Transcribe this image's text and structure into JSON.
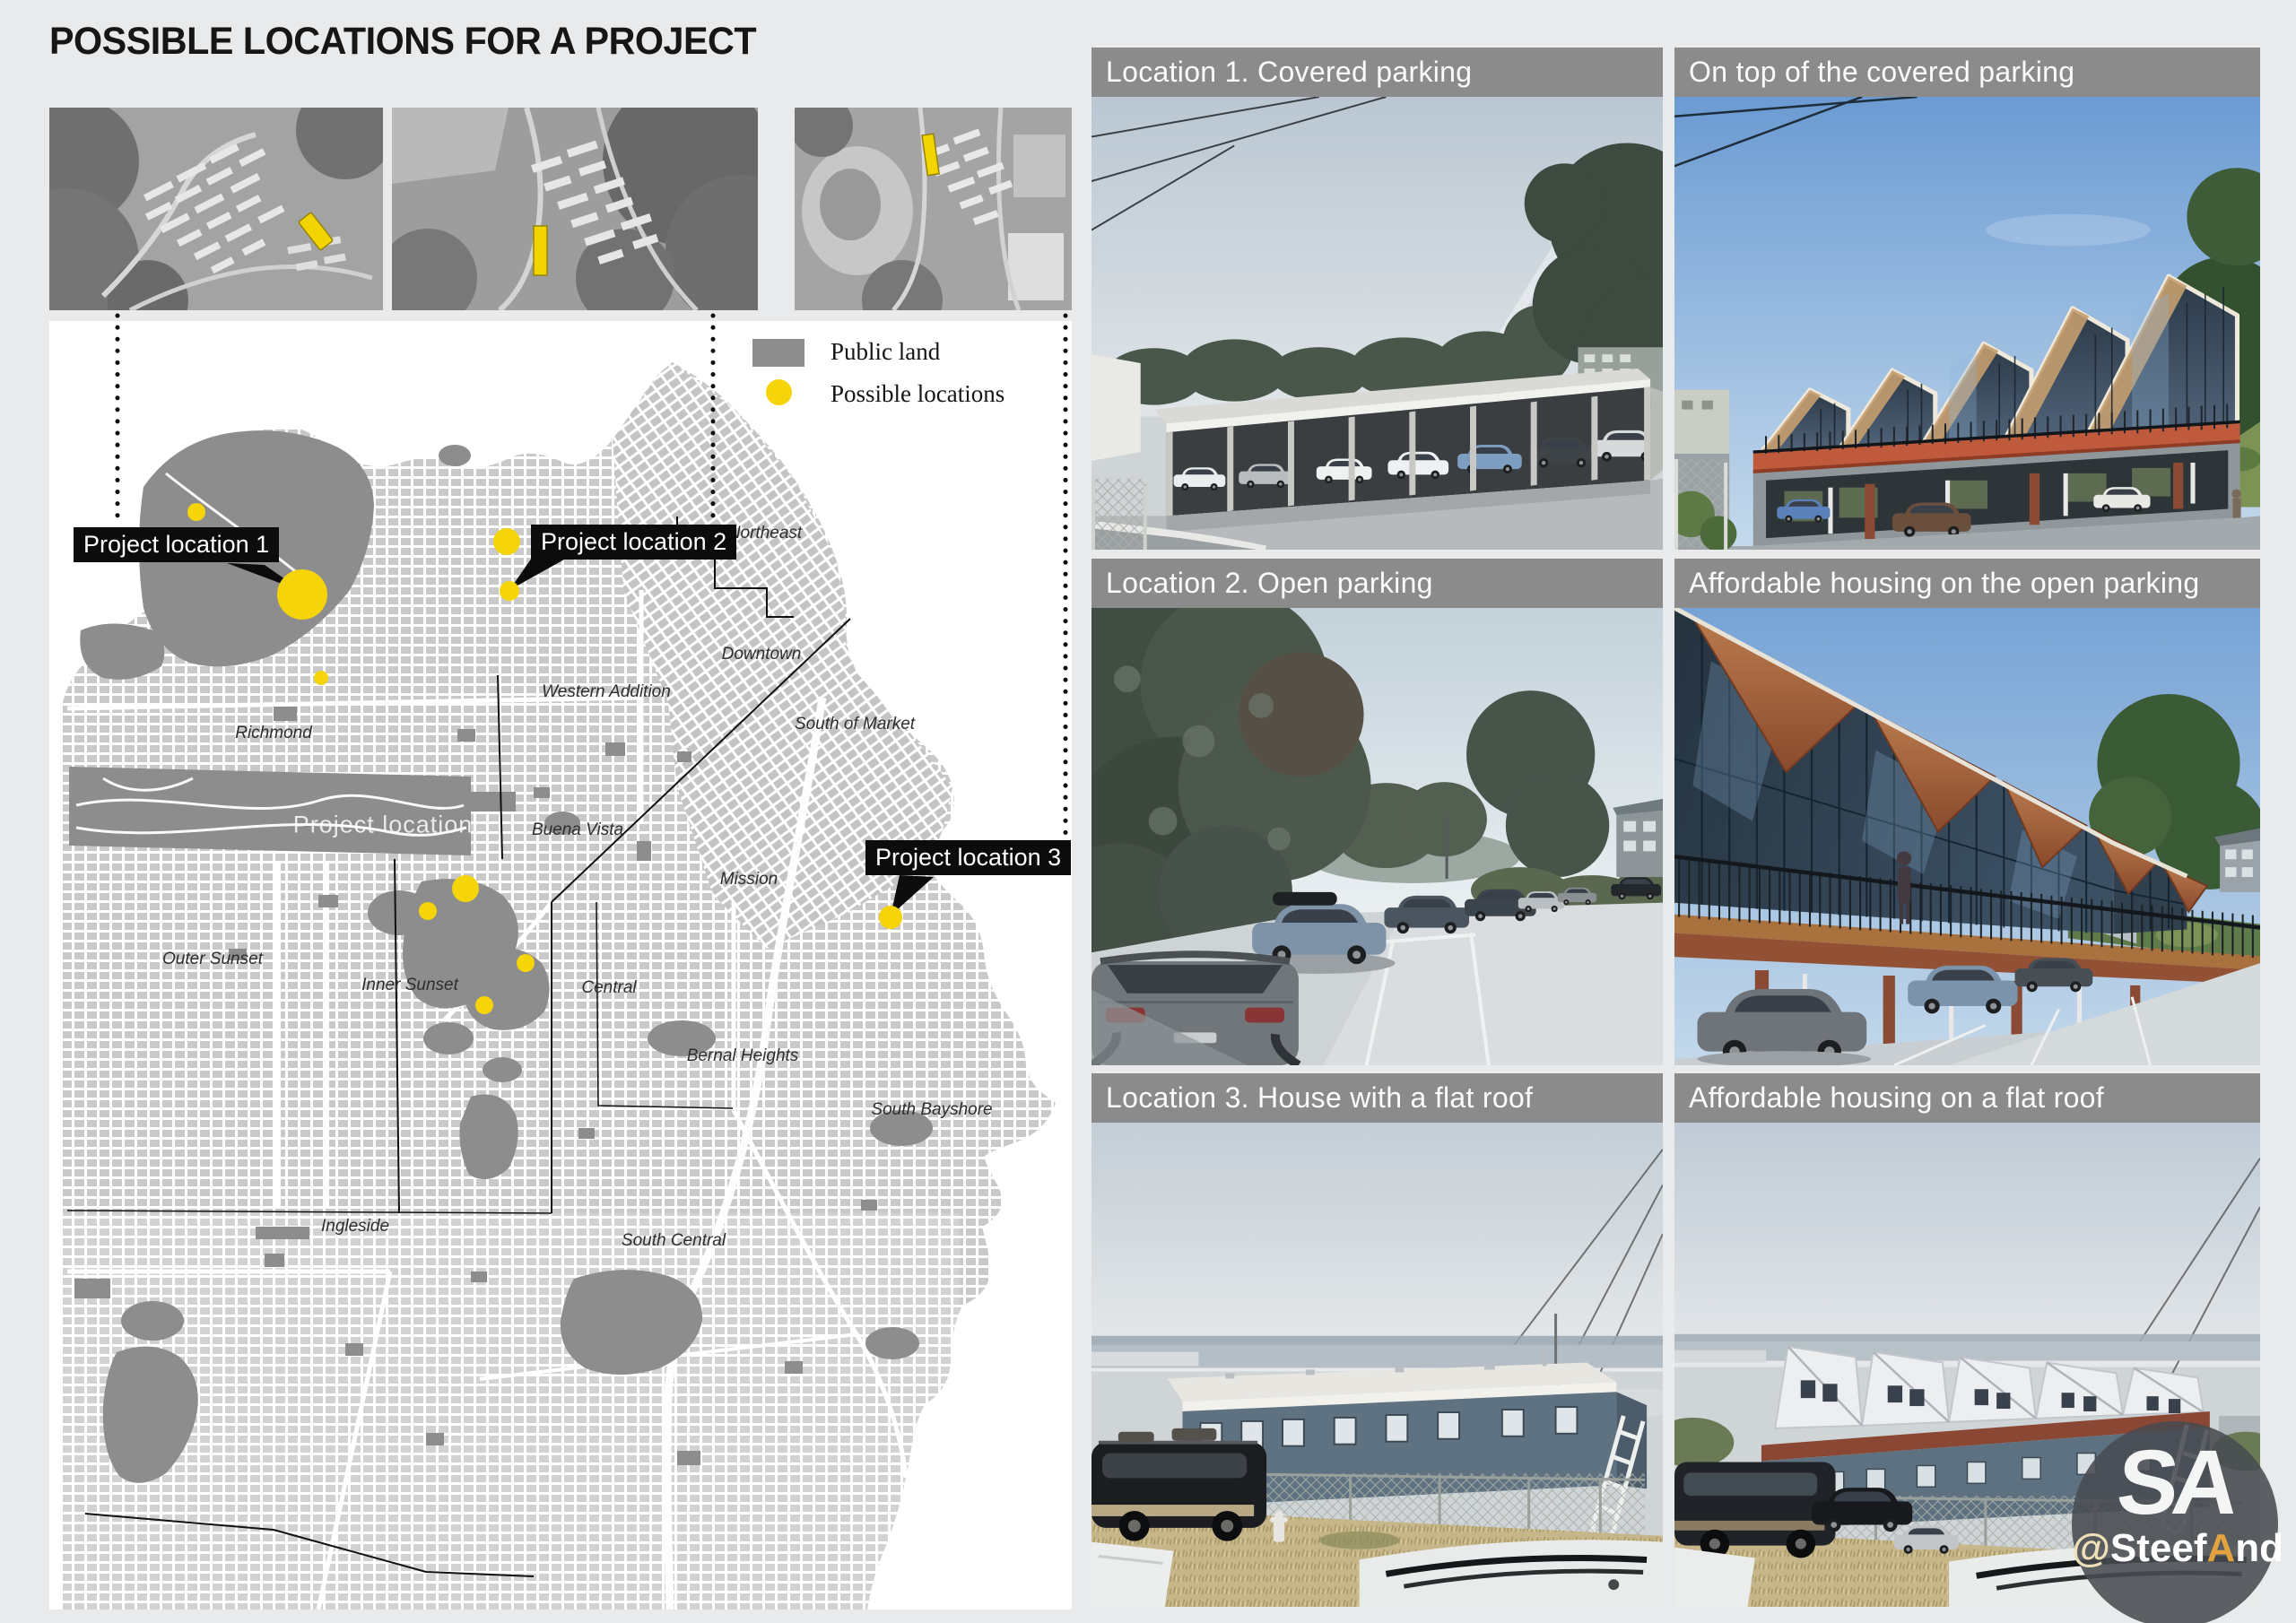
{
  "page": {
    "title": "POSSIBLE LOCATIONS FOR A PROJECT"
  },
  "map": {
    "legend": {
      "public_land": "Public land",
      "possible_locations": "Possible locations"
    },
    "ghost_label": "Project location",
    "location_labels": [
      "Project location 1",
      "Project location 2",
      "Project location 3"
    ],
    "neighborhoods": [
      "Richmond",
      "Western Addition",
      "Northeast",
      "Downtown",
      "South of Market",
      "Buena Vista",
      "Mission",
      "Inner Sunset",
      "Outer Sunset",
      "Central",
      "Bernal Heights",
      "South Bayshore",
      "Ingleside",
      "South Central"
    ]
  },
  "panels": [
    {
      "title": "Location 1. Covered parking"
    },
    {
      "title": "On top of the covered parking"
    },
    {
      "title": "Location 2. Open parking"
    },
    {
      "title": "Affordable housing on the open parking"
    },
    {
      "title": "Location 3. House with a flat roof"
    },
    {
      "title": "Affordable housing on a flat roof"
    }
  ],
  "badge": {
    "initials": "SA",
    "handle_prefix": "Steef",
    "handle_at": "@",
    "handle_accent": "A",
    "handle_suffix": "nd"
  },
  "colors": {
    "accent_yellow": "#f5d409",
    "public_land_gray": "#8d8d8d",
    "header_gray": "#8b8b8b",
    "label_black": "#0c0c0c"
  }
}
